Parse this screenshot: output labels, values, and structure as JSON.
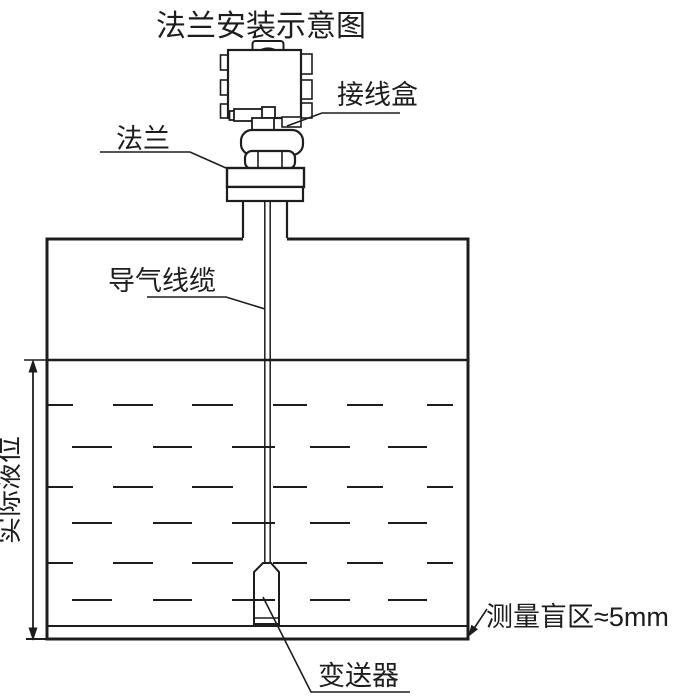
{
  "title": "法兰安装示意图",
  "labels": {
    "junction_box": "接线盒",
    "flange": "法兰",
    "air_cable": "导气线缆",
    "actual_level": "实际液位",
    "transmitter": "变送器",
    "blind_zone": "测量盲区≈5mm"
  },
  "colors": {
    "line": "#1d1d1d",
    "background": "#ffffff"
  }
}
